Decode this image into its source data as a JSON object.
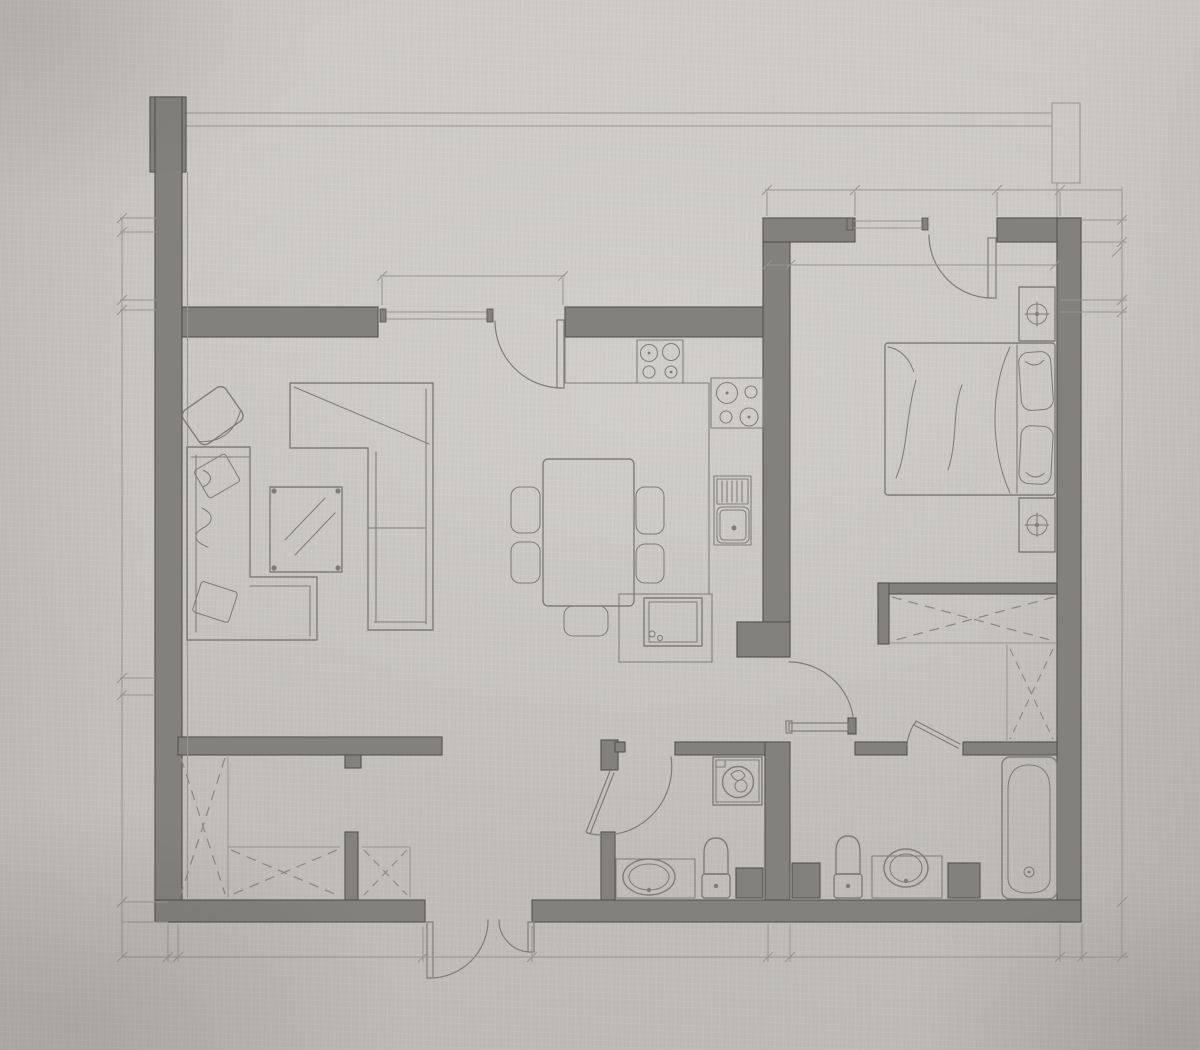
{
  "plan": {
    "style": "hand-drafted apartment floor plan, pencil style on textured gray paper, no text labels",
    "rooms": [
      {
        "name": "balcony-terrace",
        "position": "top",
        "items": [
          "railing-line",
          "corner-pillar"
        ]
      },
      {
        "name": "living-dining-room",
        "position": "left-center",
        "items": [
          "armchair",
          "corner-sofa",
          "throw-pillows",
          "coffee-table-glass",
          "sectional-sofa",
          "dining-table",
          "dining-chairs-x5"
        ]
      },
      {
        "name": "kitchen",
        "position": "center",
        "items": [
          "counter",
          "hob-4-burner",
          "cooktop-4-burner",
          "sink-with-drainboard",
          "oven-appliance"
        ]
      },
      {
        "name": "bedroom",
        "position": "right",
        "items": [
          "double-bed",
          "pillows-x2",
          "nightstand-with-lamp-x2",
          "built-in-wardrobe-x2"
        ]
      },
      {
        "name": "hallway",
        "position": "center",
        "items": []
      },
      {
        "name": "hall-bathroom",
        "position": "bottom-center",
        "items": [
          "washing-machine",
          "washbasin-vanity",
          "toilet"
        ]
      },
      {
        "name": "main-bathroom",
        "position": "bottom-right",
        "items": [
          "bathtub",
          "washbasin-vanity",
          "toilet"
        ]
      },
      {
        "name": "storage-dressing-room",
        "position": "bottom-left",
        "items": [
          "dashed-wardrobe-x3"
        ]
      }
    ],
    "openings": {
      "windows": [
        "living-room-window-top",
        "bedroom-window-top"
      ],
      "doors": [
        "living-balcony-door",
        "bedroom-balcony-door",
        "bedroom-room-door",
        "hall-bathroom-door",
        "main-bathroom-door",
        "entry-double-door-bottom"
      ]
    },
    "annotations": [
      "dimension-lines-left",
      "dimension-lines-bottom",
      "dimension-lines-right",
      "dimension-lines-top",
      "tick-marks-no-numbers"
    ]
  },
  "colors": {
    "paper": "#c9c6c0",
    "paper_light": "#d7d4ce",
    "paper_dark": "#aeaba6",
    "wall_fill": "#83817b",
    "wall_edge": "#55534e",
    "line": "#7f7d77",
    "thin_line": "#98958e",
    "dash": "#8d8a84"
  }
}
